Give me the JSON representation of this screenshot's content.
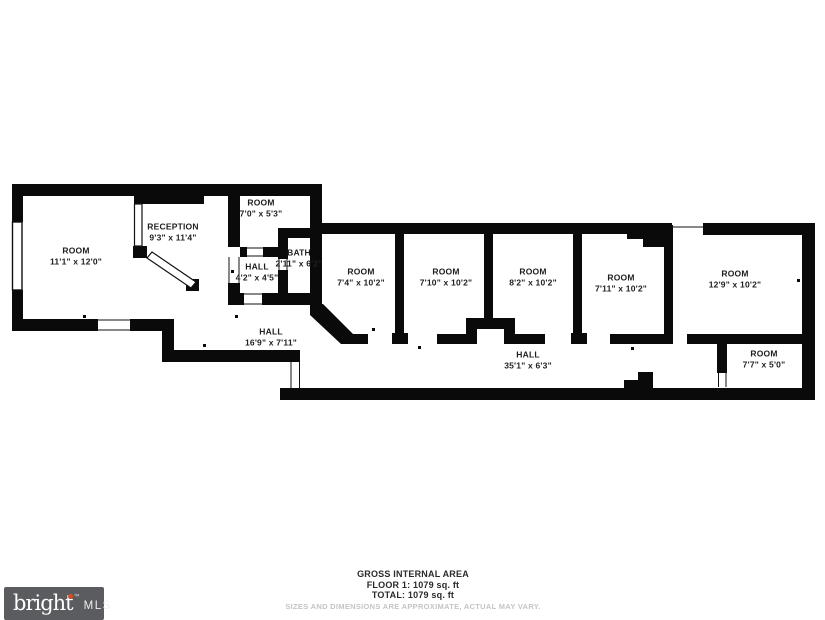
{
  "rooms": [
    {
      "name": "ROOM",
      "dims": "11'1\" x 12'0\""
    },
    {
      "name": "RECEPTION",
      "dims": "9'3\" x 11'4\""
    },
    {
      "name": "ROOM",
      "dims": "7'0\" x 5'3\""
    },
    {
      "name": "HALL",
      "dims": "4'2\" x 4'5\""
    },
    {
      "name": "BATH",
      "dims": "2'11\" x 6'2\""
    },
    {
      "name": "ROOM",
      "dims": "7'4\" x 10'2\""
    },
    {
      "name": "ROOM",
      "dims": "7'10\" x 10'2\""
    },
    {
      "name": "ROOM",
      "dims": "8'2\" x 10'2\""
    },
    {
      "name": "ROOM",
      "dims": "7'11\" x 10'2\""
    },
    {
      "name": "ROOM",
      "dims": "12'9\" x 10'2\""
    },
    {
      "name": "HALL",
      "dims": "16'9\" x 7'11\""
    },
    {
      "name": "HALL",
      "dims": "35'1\" x 6'3\""
    },
    {
      "name": "ROOM",
      "dims": "7'7\" x 5'0\""
    }
  ],
  "footer": {
    "title": "GROSS INTERNAL AREA",
    "floor": "FLOOR 1: 1079 sq. ft",
    "total": "TOTAL: 1079 sq. ft",
    "disclaimer": "SIZES AND DIMENSIONS ARE APPROXIMATE, ACTUAL MAY VARY."
  },
  "logo": {
    "brand": "bright",
    "tm": "™",
    "suffix": "MLS",
    "accent_color": "#cf5127",
    "bg_color": "#5b5c60"
  },
  "colors": {
    "wall": "#0a0a0a",
    "background": "#ffffff",
    "disclaimer_text": "#c4c4c4"
  }
}
